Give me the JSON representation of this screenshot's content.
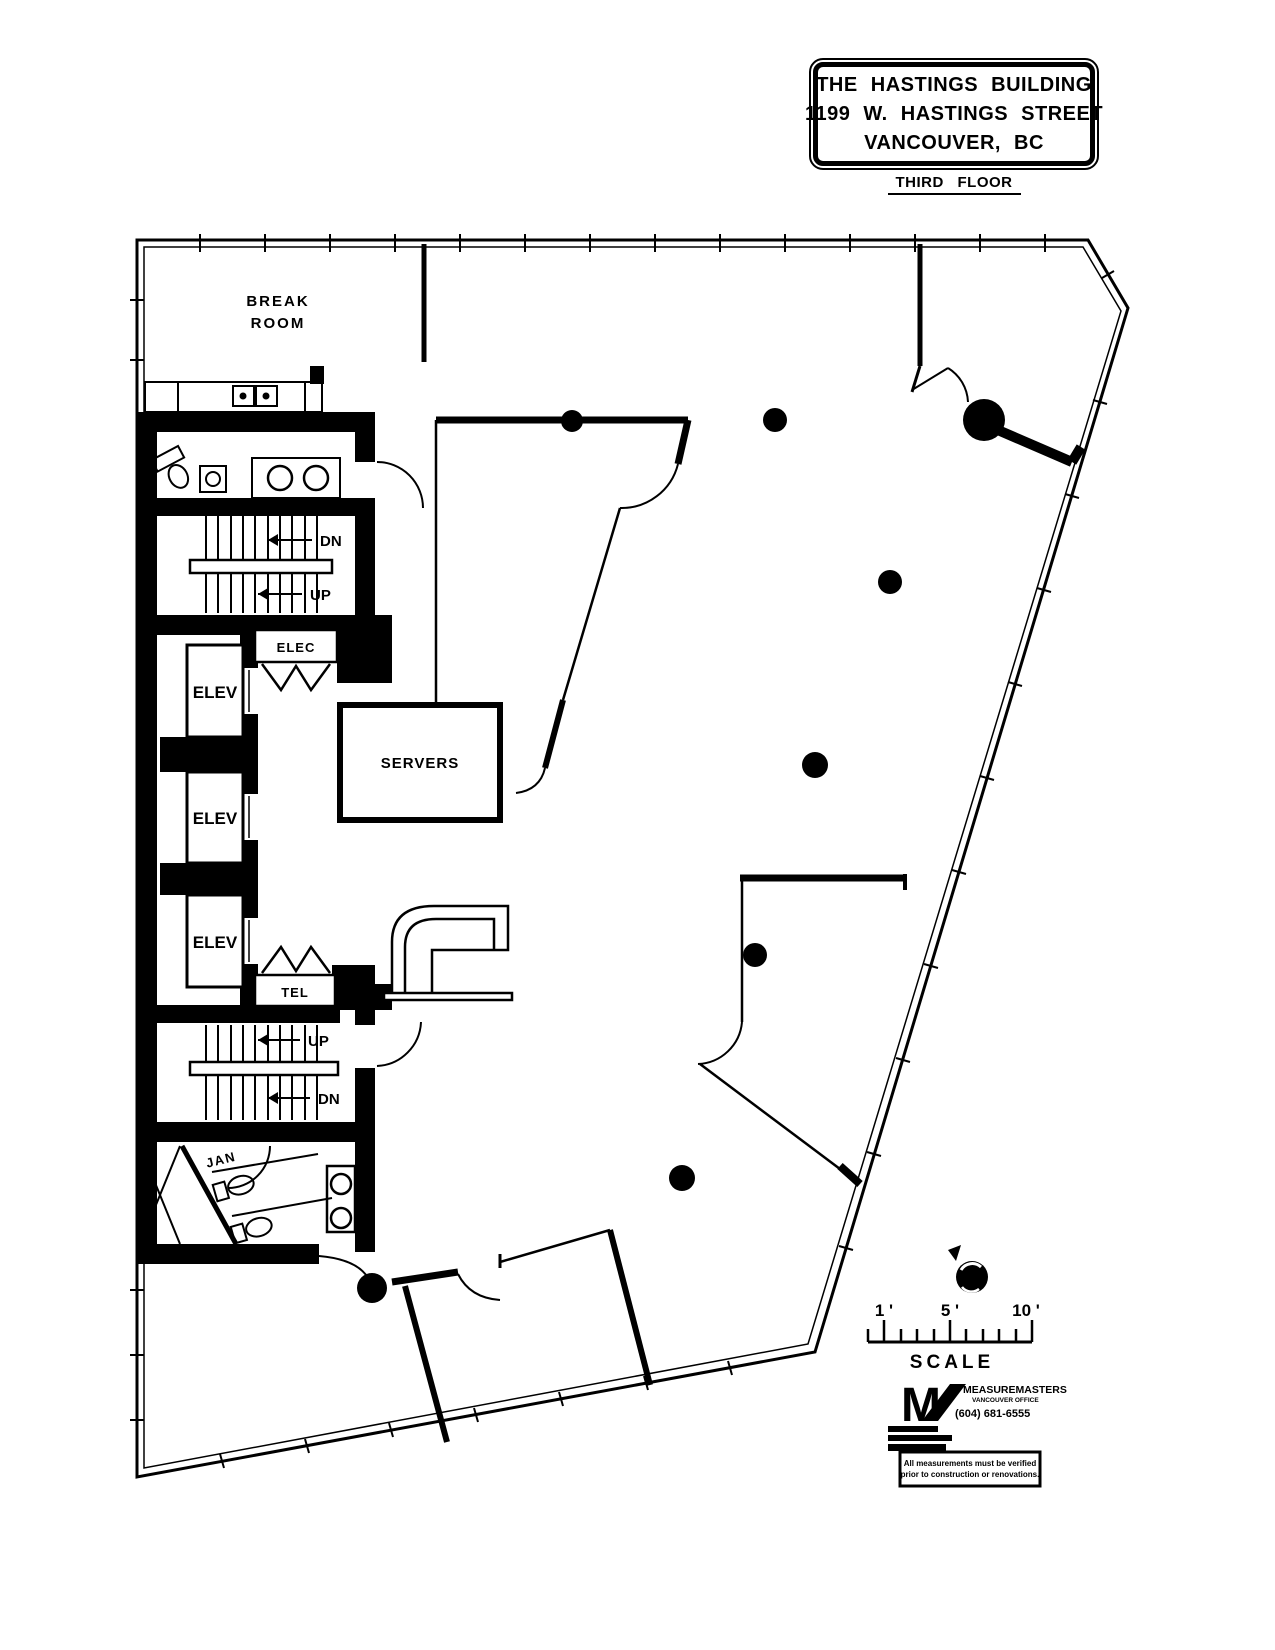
{
  "title_block": {
    "line1": "THE HASTINGS BUILDING",
    "line2": "1199 W. HASTINGS STREET",
    "line3": "VANCOUVER, BC"
  },
  "floor_label": "THIRD FLOOR",
  "labels": {
    "break_room": {
      "line1": "BREAK",
      "line2": "ROOM"
    },
    "elec": "ELEC",
    "elev": "ELEV",
    "servers": "SERVERS",
    "tel": "TEL",
    "jan": "JAN",
    "stair_upper": {
      "dn": "DN",
      "up": "UP"
    },
    "stair_lower": {
      "up": "UP",
      "dn": "DN"
    }
  },
  "scale_bar": {
    "label_1": "1 '",
    "label_5": "5 '",
    "label_10": "10 '",
    "caption": "SCALE"
  },
  "vendor": {
    "logo_letter": "M",
    "brand": "MEASUREMASTERS",
    "branch": "VANCOUVER OFFICE",
    "phone": "(604) 681-6555",
    "disclaimer1": "All measurements must be verified",
    "disclaimer2": "prior to construction or renovations."
  },
  "colors": {
    "ink": "#000000",
    "paper": "#ffffff"
  }
}
